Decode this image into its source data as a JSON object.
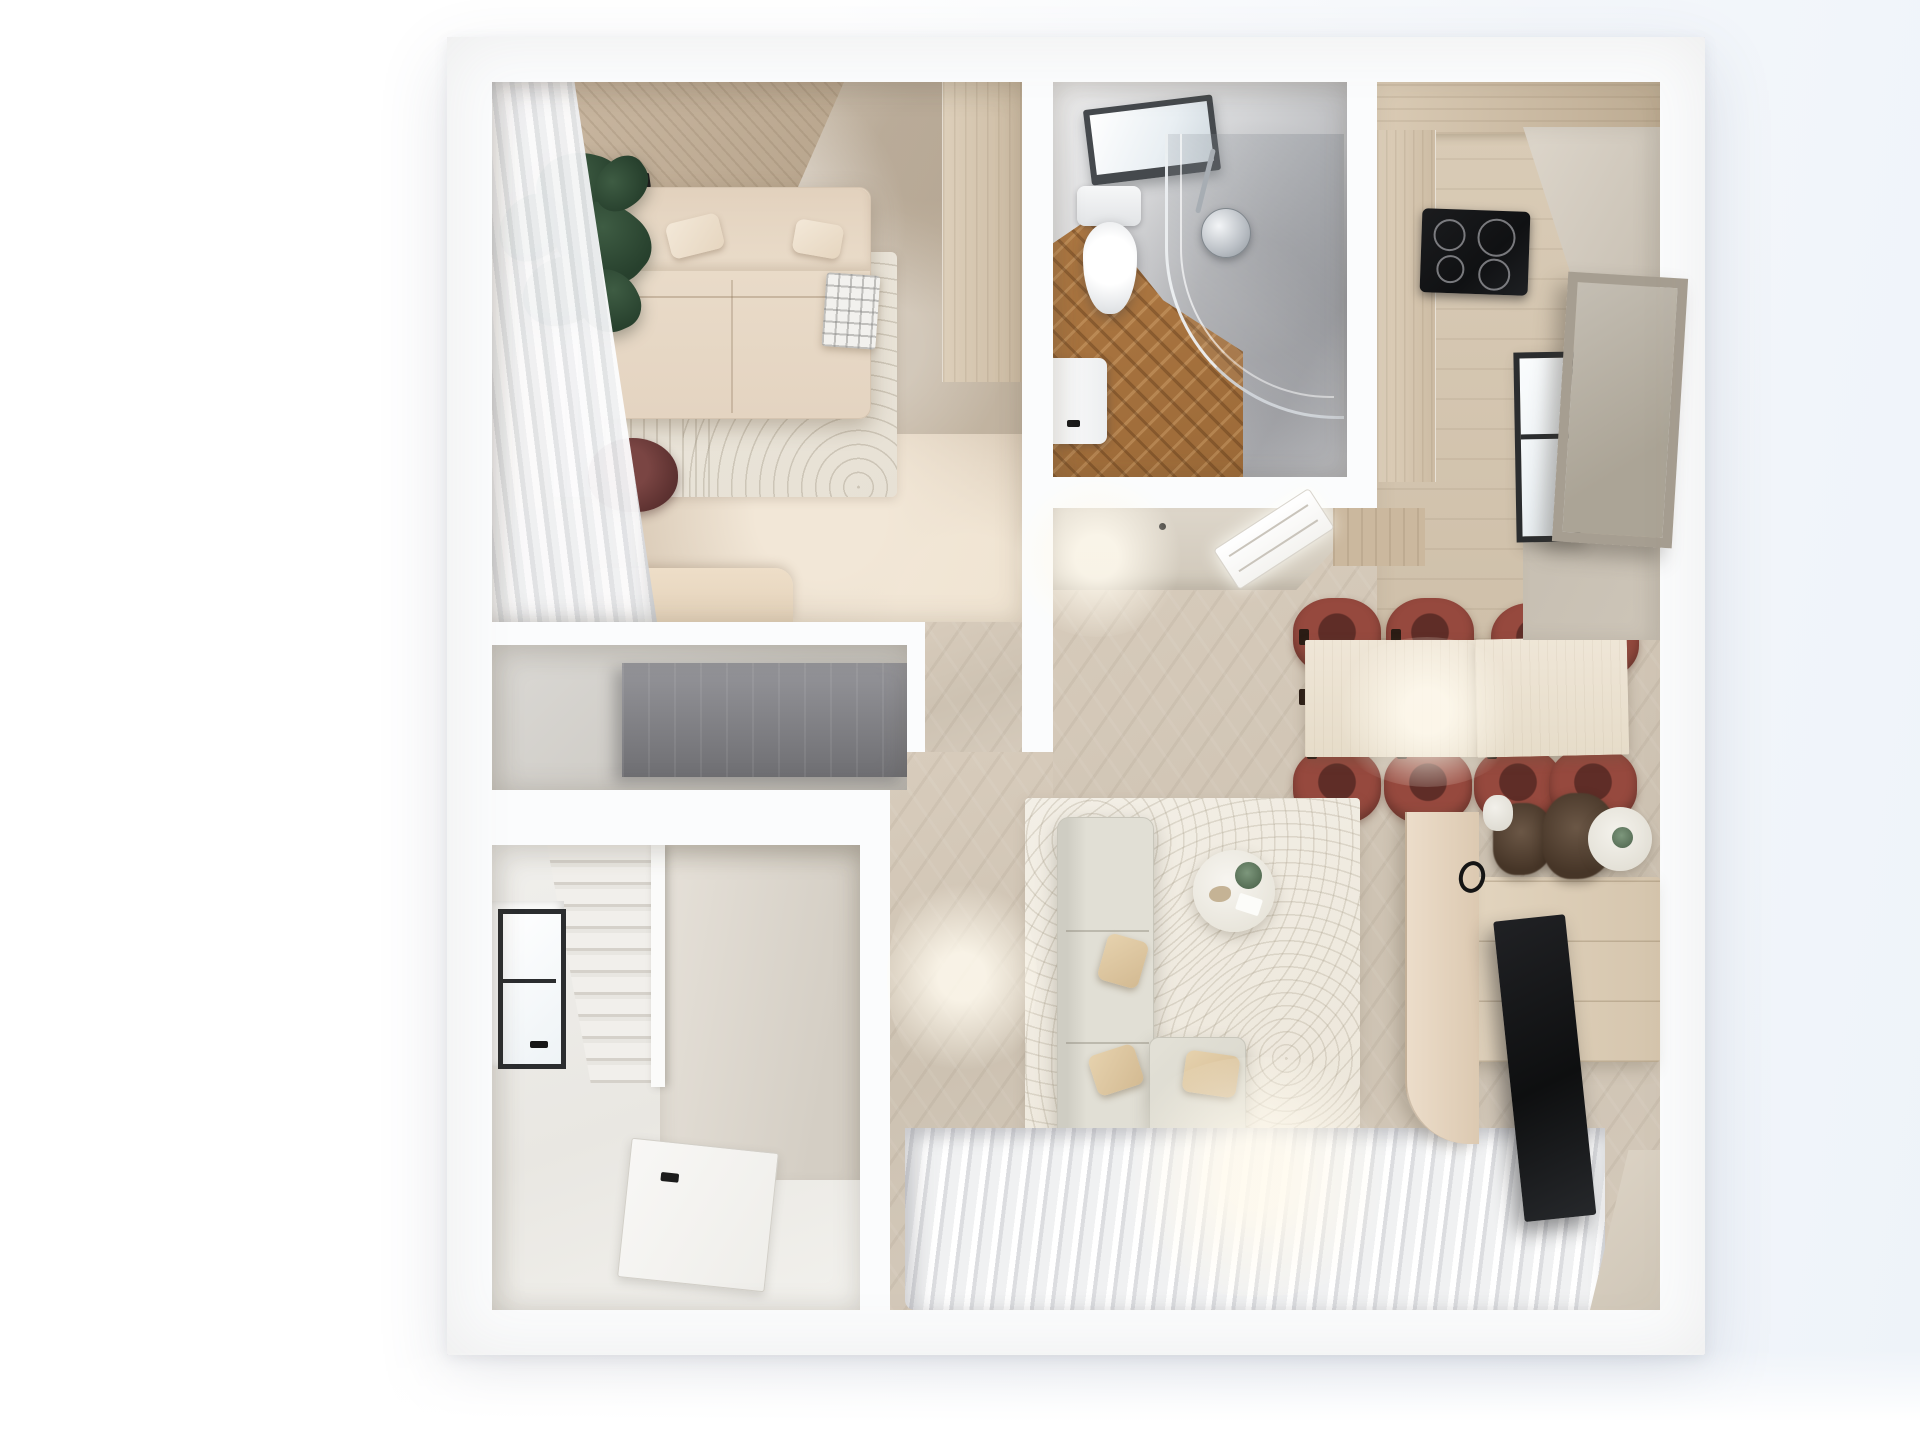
{
  "scene": {
    "type": "floor-plan-3d-render",
    "description": "Photorealistic top-down 3D render of a small apartment floor plan on a white background",
    "view": "top-down orthographic",
    "text_content": "none visible"
  },
  "palette": {
    "wall_white": "#fbfcfd",
    "bedroom_floor": "#d7c7b3",
    "curtain": "#f0f1f2",
    "wood_headboard": "#c9b7a1",
    "marble": "#cabdab",
    "sofa_bed": "#e4d4c1",
    "plant": "#27402d",
    "rug_bedroom": "#e7e1d5",
    "desk": "#e3d2ba",
    "chair_maroon": "#5e3231",
    "niche_wall": "#ccc9c3",
    "wardrobe_gray": "#6f6f73",
    "hall_wall": "#e9e7e2",
    "stair_step": "#f1efeb",
    "window_frame": "#2b2d2f",
    "door": "#efeeea",
    "bath_wall": "#a9aaae",
    "bath_floor": "#9c6a38",
    "chrome": "#8f969c",
    "kitchen_wood": "#daccb7",
    "cooktop": "#101113",
    "greige_wall": "#c7bfb2",
    "artwork": "#aba496",
    "herringbone": "#d8ccbc",
    "dining_table": "#e6dcc9",
    "dining_chair": "#96493e",
    "living_rug": "#ece6da",
    "sofa_gray": "#e1dfd5",
    "pillow_tan": "#d3ba92",
    "console_wood": "#d5c5ad",
    "tv_black": "#0e0f10",
    "partition": "#dcc9b1",
    "glass_green": "#566e55"
  },
  "rooms": [
    {
      "name": "bedroom",
      "furniture": [
        "sheer curtain wall",
        "wood headboard panel",
        "marble accent wall",
        "wardrobe column",
        "double sofa bed with pillows and plaid throw",
        "fiddle leaf plant",
        "striped arc rug",
        "desk",
        "maroon desk chair"
      ]
    },
    {
      "name": "bathroom",
      "furniture": [
        "skylight window",
        "toilet",
        "curved glass shower with chrome head",
        "herringbone wood floor",
        "sink"
      ]
    },
    {
      "name": "kitchen",
      "furniture": [
        "upper cabinet run",
        "tall cabinet column",
        "black induction cooktop",
        "plank wood floor"
      ]
    },
    {
      "name": "dining-area",
      "furniture": [
        "two-slab wood dining table",
        "eight maroon dining chairs",
        "wall window",
        "leaning framed artwork",
        "recessed linear ceiling light"
      ]
    },
    {
      "name": "living-room",
      "furniture": [
        "arc pattern rug",
        "L-shaped gray sofa with tan pillows",
        "round coffee table with green glass vase",
        "wood TV console",
        "wall TV panel",
        "curved partition",
        "dried plant decor",
        "sheer window curtains"
      ]
    },
    {
      "name": "storage-niche",
      "furniture": [
        "gray wardrobe unit"
      ]
    },
    {
      "name": "stair-hall",
      "furniture": [
        "staircase",
        "stair divider wall",
        "window",
        "entry door with black handle"
      ]
    },
    {
      "name": "hallway",
      "furniture": [
        "herringbone floor"
      ]
    }
  ]
}
